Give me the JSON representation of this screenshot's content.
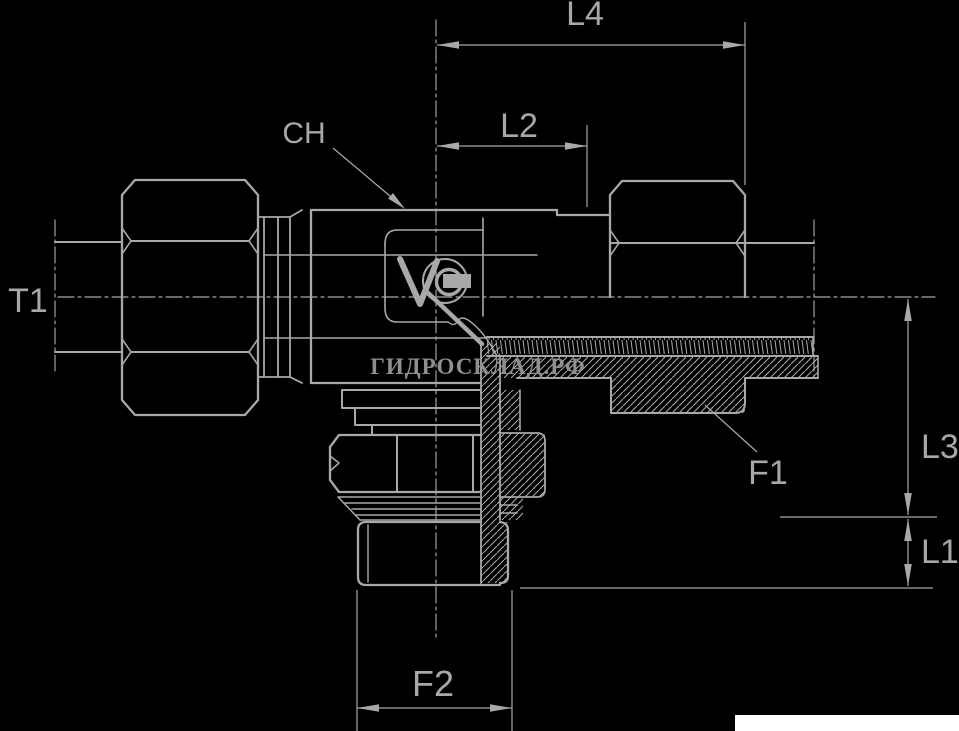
{
  "canvas": {
    "background": "#000000",
    "line_color": "#a8a8a8",
    "text_color": "#a8a8a8"
  },
  "labels": {
    "l4": "L4",
    "l2": "L2",
    "ch": "CH",
    "t1": "T1",
    "f1": "F1",
    "l3": "L3",
    "l1": "L1",
    "f2": "F2"
  },
  "watermark": {
    "text": "ГИДРОСКЛАД.РФ",
    "color": "#8f8f8f"
  },
  "footer": {
    "strip_color": "#ffffff"
  }
}
